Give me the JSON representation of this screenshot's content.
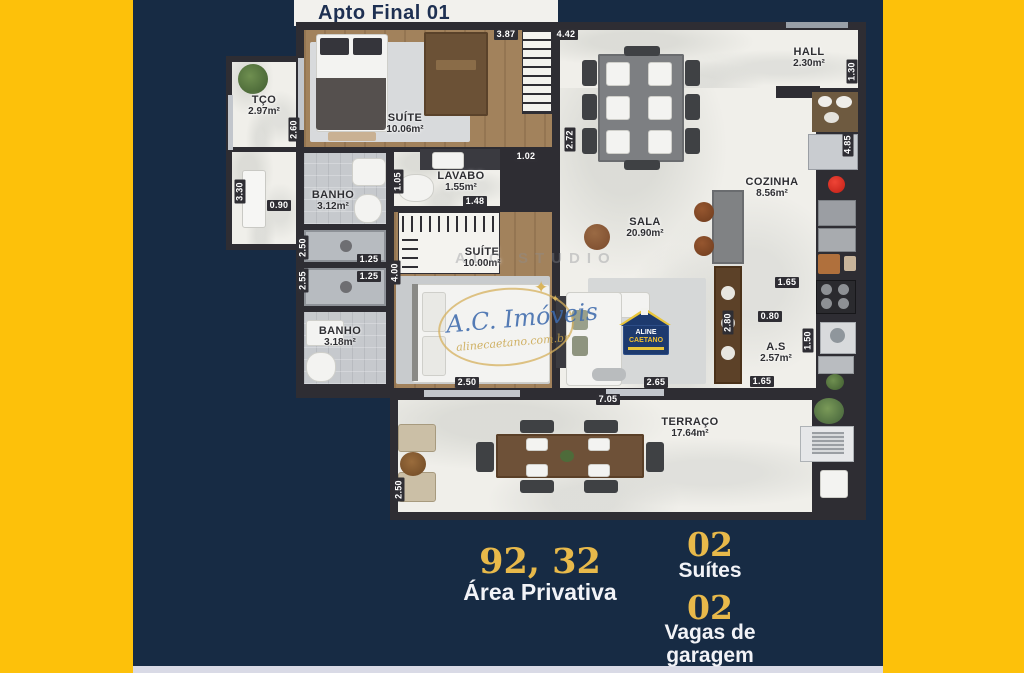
{
  "title": "Apto Final 01",
  "rooms": {
    "tco": {
      "name": "TÇO",
      "area": "2.97m²"
    },
    "suite1": {
      "name": "SUÍTE",
      "area": "10.06m²"
    },
    "banho1": {
      "name": "BANHO",
      "area": "3.12m²"
    },
    "lavabo": {
      "name": "LAVABO",
      "area": "1.55m²"
    },
    "suite2": {
      "name": "SUÍTE",
      "area": "10.00m²"
    },
    "banho2": {
      "name": "BANHO",
      "area": "3.18m²"
    },
    "sala": {
      "name": "SALA",
      "area": "20.90m²"
    },
    "hall": {
      "name": "HALL",
      "area": "2.30m²"
    },
    "cozinha": {
      "name": "COZINHA",
      "area": "8.56m²"
    },
    "as": {
      "name": "A.S",
      "area": "2.57m²"
    },
    "terraco": {
      "name": "TERRAÇO",
      "area": "17.64m²"
    }
  },
  "dimensions": {
    "suite1_width": "3.87",
    "sala_width": "4.42",
    "hall_height": "1.30",
    "suite1_left": "2.60",
    "sala_left": "2.72",
    "cozinha_right": "4.85",
    "lavabo_top": "1.02",
    "lavabo_left": "1.05",
    "lavabo_width": "1.48",
    "tco_height": "3.30",
    "tco_width": "0.90",
    "shower1_height": "2.50",
    "shower1_width": "1.25",
    "shower2_height": "2.55",
    "shower2_width": "1.25",
    "suite2_left": "4.00",
    "cozinha_width": "1.65",
    "as_opening": "0.80",
    "island_height": "2.80",
    "as_right": "1.50",
    "as_width": "1.65",
    "sala_bottom": "2.65",
    "suite2_width": "2.50",
    "terraco_width": "7.05",
    "terraco_left": "2.50"
  },
  "watermark": {
    "studio": "ALC STUDIO",
    "script": "A.C. Imóveis",
    "site": "alinecaetano.com.br",
    "badge_top": "ALINE",
    "badge_bottom": "CAETANO"
  },
  "stats": {
    "area_value": "92, 32",
    "area_label": "Área Privativa",
    "suites_value": "02",
    "suites_label": "Suítes",
    "vagas_value": "02",
    "vagas_label": "Vagas de garagem"
  },
  "colors": {
    "band_yellow": "#fdc10a",
    "background_navy": "#172b44",
    "gold_text": "#e8b94a",
    "wall_dark": "#2e2d33",
    "bottom_strip": "#d9dae6"
  }
}
